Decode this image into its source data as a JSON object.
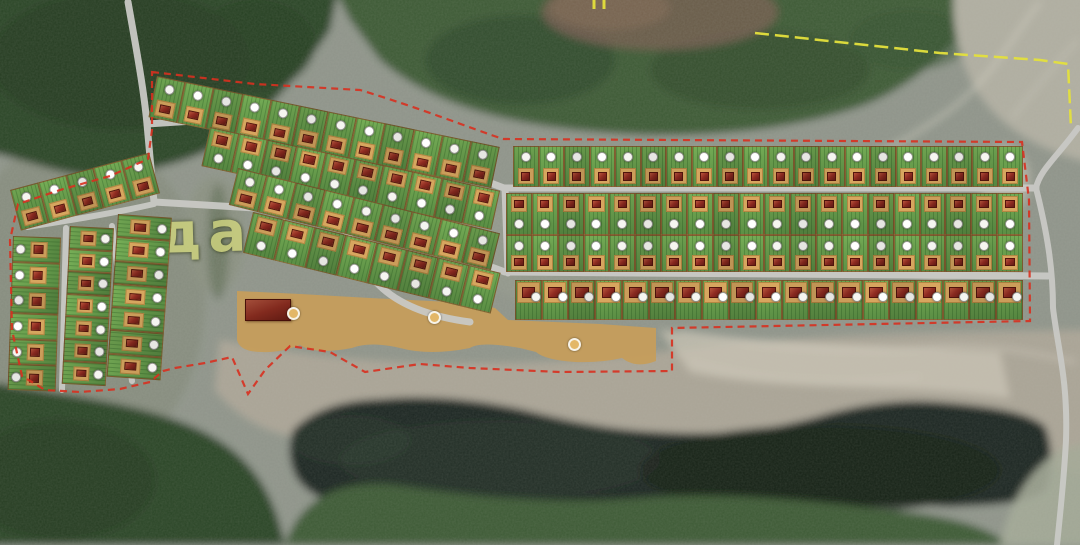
{
  "scene": {
    "description": "Aerial satellite photograph with a dacha-settlement master plan overlay: green numbered cottage plots, grey access roads, a red dashed development boundary, a yellow dashed survey line, an amenity strip with a community building and beach areas beside a dark lake",
    "watermark_text": "дач"
  },
  "colors": {
    "terrain_base": "#8f948a",
    "forest_dark": "#2c4527",
    "forest_mid": "#3d5a36",
    "field_light": "#b0aea1",
    "sand": "#aaa496",
    "sand_bright": "#ccc6b6",
    "lake": "#1c2620",
    "road": "#c9c9c5",
    "plot_green": "#6fa351",
    "plot_green_dark": "#558540",
    "pad_tan": "#cb9d5a",
    "pad_border": "#a87f3e",
    "beach_tan": "#c59d5c",
    "roof_red": "#87291f",
    "roof_red_light": "#a84a35",
    "roof_red_dark": "#5e1a14",
    "circle_fill": "#f5f5f0",
    "circle_ring": "#8f8f8a",
    "marker_orange": "#e3b768",
    "boundary_red": "#d8301f",
    "survey_yellow": "#e4e03c",
    "watermark": "#cfd47e"
  },
  "plan": {
    "rows": [
      {
        "name": "row-north-west-1",
        "x": 157,
        "y": 76,
        "w": 350,
        "h": 42,
        "angle": 11.7,
        "count": 12,
        "house": "bottom"
      },
      {
        "name": "row-north-west-2",
        "x": 210,
        "y": 127,
        "w": 297,
        "h": 40,
        "angle": 12.4,
        "count": 10,
        "house": "top"
      },
      {
        "name": "row-north-west-3",
        "x": 238,
        "y": 168,
        "w": 270,
        "h": 38,
        "angle": 14,
        "count": 9,
        "house": "bottom"
      },
      {
        "name": "row-north-west-4",
        "x": 253,
        "y": 212,
        "w": 255,
        "h": 42,
        "angle": 13.8,
        "count": 8,
        "house": "top"
      },
      {
        "name": "row-east-north",
        "x": 513,
        "y": 146,
        "w": 510,
        "h": 41,
        "angle": 0,
        "count": 20,
        "house": "bottom"
      },
      {
        "name": "row-east-mid-upper",
        "x": 506,
        "y": 193,
        "w": 517,
        "h": 42,
        "angle": 0,
        "count": 20,
        "house": "top"
      },
      {
        "name": "row-east-mid-lower",
        "x": 506,
        "y": 235,
        "w": 517,
        "h": 37,
        "angle": 0,
        "count": 20,
        "house": "bottom"
      },
      {
        "name": "row-east-south",
        "x": 515,
        "y": 280,
        "w": 508,
        "h": 40,
        "angle": 0,
        "count": 19,
        "house": "topwide"
      },
      {
        "name": "row-west-top",
        "x": 10,
        "y": 190,
        "w": 144,
        "h": 42,
        "angle": -15,
        "count": 5,
        "house": "bottom"
      },
      {
        "name": "column-west-1",
        "x": 13,
        "y": 236,
        "w": 48,
        "h": 154,
        "angle": 2,
        "count": 6,
        "house": "rowl",
        "dir": "col"
      },
      {
        "name": "column-west-2",
        "x": 70,
        "y": 226,
        "w": 44,
        "h": 158,
        "angle": 3,
        "count": 7,
        "house": "row",
        "dir": "col"
      },
      {
        "name": "column-west-3",
        "x": 118,
        "y": 214,
        "w": 54,
        "h": 163,
        "angle": 4,
        "count": 7,
        "house": "row",
        "dir": "col"
      }
    ],
    "amenity": {
      "building": {
        "x": 245,
        "y": 299,
        "w": 46,
        "h": 22
      },
      "markers": [
        {
          "x": 293,
          "y": 313
        },
        {
          "x": 434,
          "y": 317
        },
        {
          "x": 574,
          "y": 344
        }
      ]
    }
  }
}
